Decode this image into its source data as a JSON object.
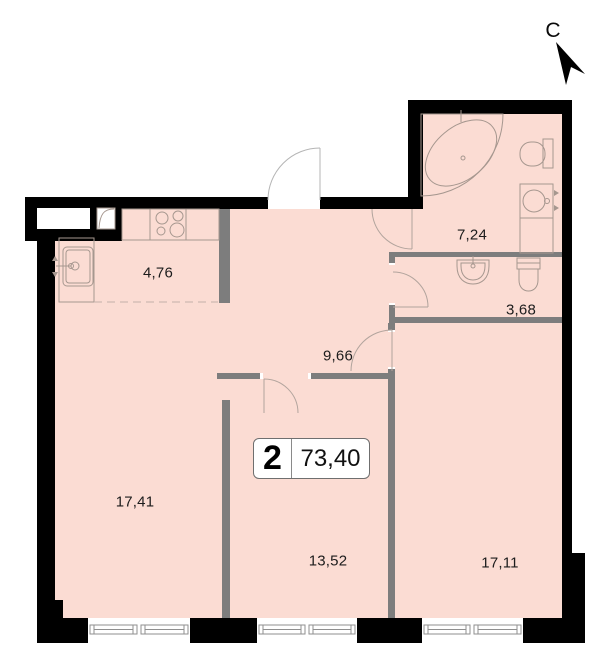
{
  "plan": {
    "north_label": "С",
    "badge": {
      "room_count": "2",
      "total_area": "73,40"
    },
    "rooms": [
      {
        "name": "kitchen",
        "area": "4,76"
      },
      {
        "name": "bathroom",
        "area": "7,24"
      },
      {
        "name": "wc",
        "area": "3,68"
      },
      {
        "name": "hallway",
        "area": "9,66"
      },
      {
        "name": "living-room",
        "area": "17,41"
      },
      {
        "name": "bedroom",
        "area": "13,52"
      },
      {
        "name": "bedroom-2",
        "area": "17,11"
      }
    ],
    "colors": {
      "floor": "#fbdcd3",
      "exterior_wall": "#000000",
      "partition_wall": "#7d7d7d",
      "fixture_line": "#a6978f",
      "door_arc": "#b2a49d"
    }
  }
}
